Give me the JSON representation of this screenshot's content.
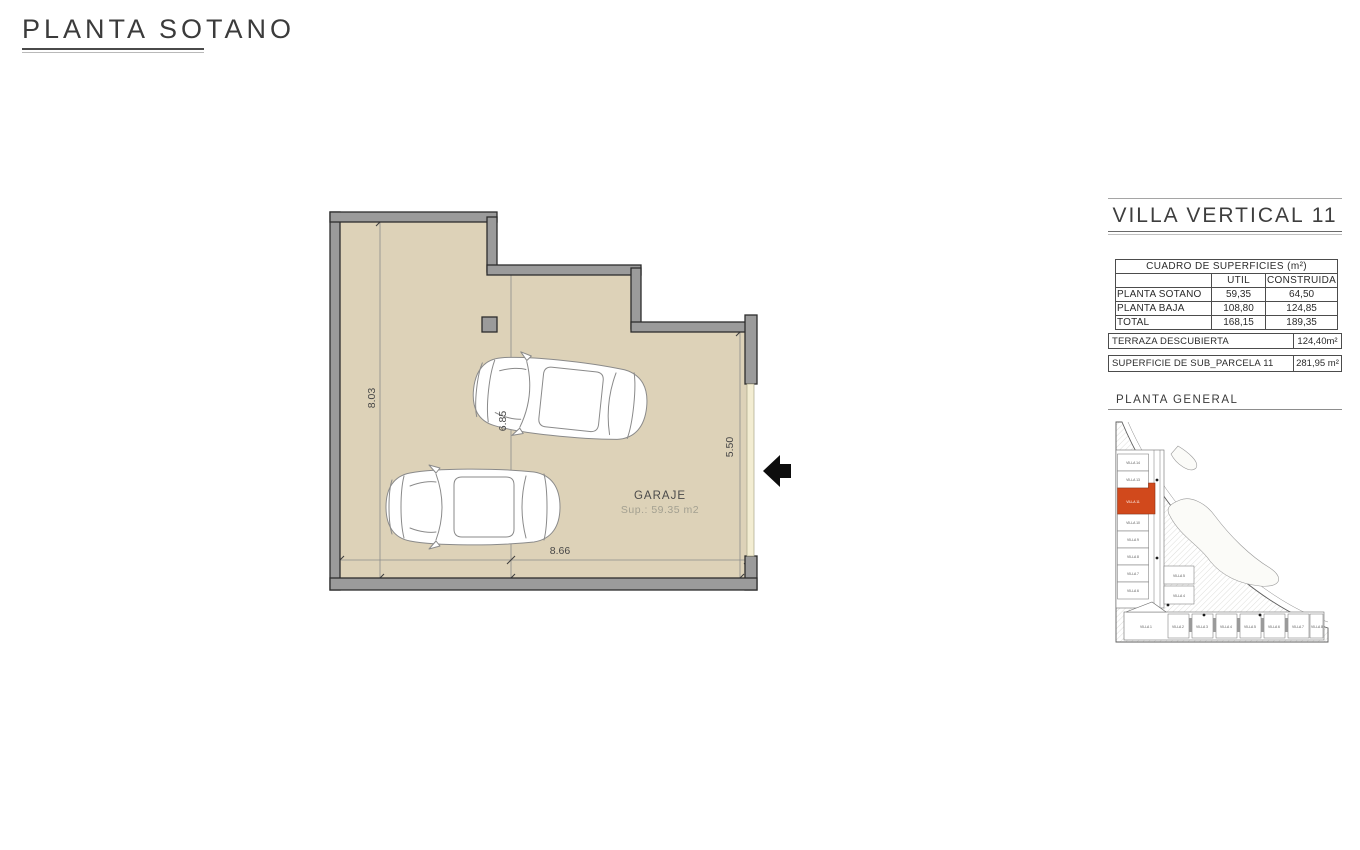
{
  "page": {
    "title": "PLANTA SOTANO"
  },
  "plan": {
    "room_label": "GARAJE",
    "room_area": "Sup.: 59.35 m2",
    "dims": {
      "left": "8.03",
      "middle": "6.85",
      "right": "5.50",
      "bottom": "8.66"
    },
    "colors": {
      "floor": "#ddd2b8",
      "wall": "#9b9b9b",
      "wall_outline": "#2d2d2d",
      "door_strip": "#f3edd2",
      "arrow": "#0d0d0d"
    }
  },
  "panel": {
    "title": "VILLA VERTICAL 11",
    "surfaces_table": {
      "header": "CUADRO DE SUPERFICIES (m²)",
      "columns": {
        "util": "UTIL",
        "construida": "CONSTRUIDA"
      },
      "rows": [
        {
          "label": "PLANTA SOTANO",
          "util": "59,35",
          "construida": "64,50"
        },
        {
          "label": "PLANTA BAJA",
          "util": "108,80",
          "construida": "124,85"
        },
        {
          "label": "TOTAL",
          "util": "168,15",
          "construida": "189,35"
        }
      ]
    },
    "terraza": {
      "label": "TERRAZA DESCUBIERTA",
      "value": "124,40m²"
    },
    "parcela": {
      "label": "SUPERFICIE DE SUB_PARCELA 11",
      "value": "281,95 m²"
    },
    "siteplan_title": "PLANTA GENERAL",
    "siteplan": {
      "highlighted_unit": "VILLA 11",
      "highlight_color": "#d1491c",
      "left_units": [
        "VILLA 14",
        "VILLA 13",
        "VILLA 11",
        "VILLA 10",
        "VILLA 9",
        "VILLA 8",
        "VILLA 7",
        "VILLA 6"
      ],
      "inner_units": [
        "VILLA 5",
        "VILLA 4"
      ],
      "bottom_units": [
        "VILLA 1",
        "VILLA 2",
        "VILLA 3",
        "VILLA 4",
        "VILLA 5",
        "VILLA 6",
        "VILLA 7",
        "VILLA 8"
      ]
    }
  }
}
